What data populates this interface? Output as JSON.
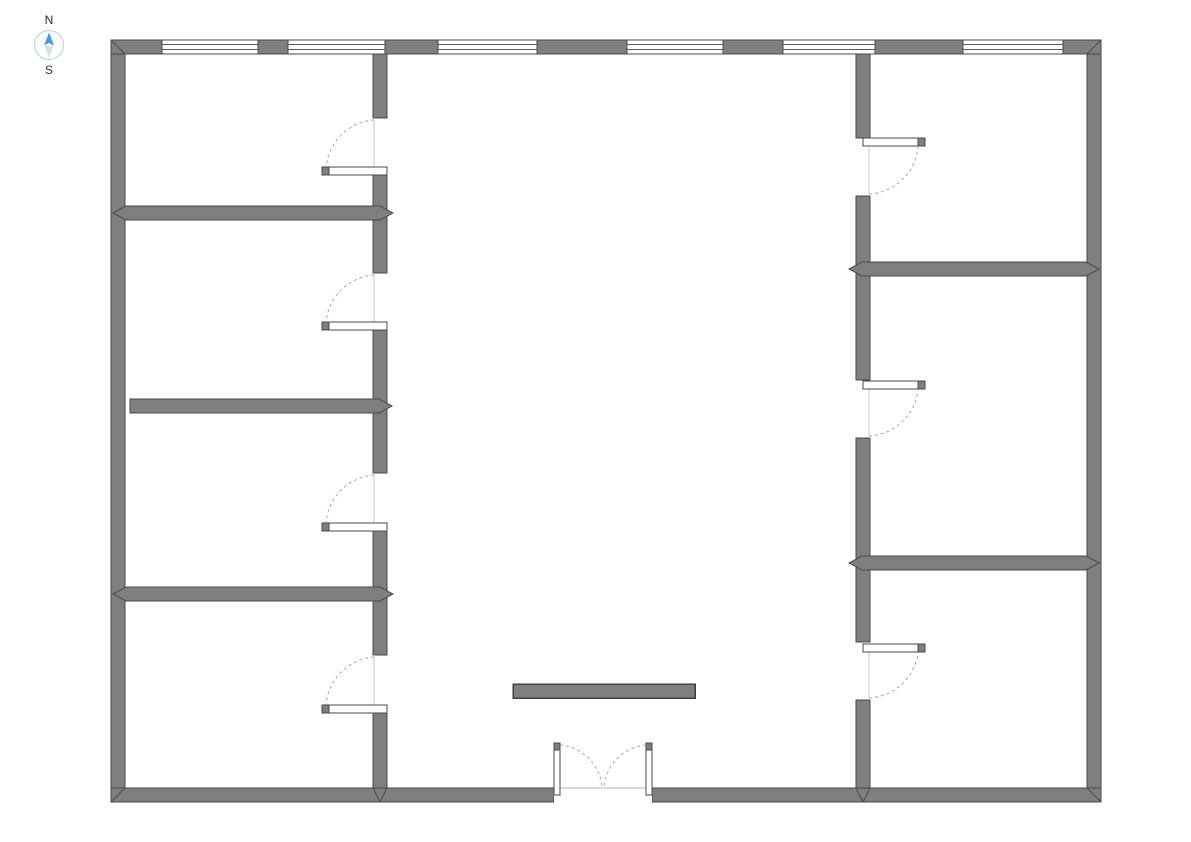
{
  "compass": {
    "north_label": "N",
    "south_label": "S"
  },
  "colors": {
    "background": "#ffffff",
    "wall_fill": "#7f7f7f",
    "wall_edge": "#4a4a4a",
    "window_fill": "#ffffff",
    "window_line": "#5a5a5a",
    "door_leaf_fill": "#ffffff",
    "door_leaf_edge": "#4a4a4a",
    "door_tip_fill": "#7f7f7f",
    "door_arc": "#a9a9a9",
    "door_frame": "#c9c9c9",
    "threshold": "#b4b4b4",
    "furniture_fill": "#7f7f7f",
    "furniture_edge": "#3f3f3f",
    "compass_north": "#3f9ce8",
    "compass_south": "#d9dee3",
    "compass_ring": "#b9d7ec"
  },
  "plan": {
    "canvas": {
      "w": 1191,
      "h": 842
    },
    "walls": [
      {
        "name": "exterior-wall-left",
        "x": 111,
        "y": 40,
        "w": 14,
        "h": 762
      },
      {
        "name": "exterior-wall-right",
        "x": 1087,
        "y": 40,
        "w": 14,
        "h": 762
      },
      {
        "name": "exterior-wall-top-segment-1",
        "x": 111,
        "y": 40,
        "w": 51,
        "h": 14
      },
      {
        "name": "exterior-wall-top-segment-2",
        "x": 258,
        "y": 40,
        "w": 30,
        "h": 14
      },
      {
        "name": "exterior-wall-top-segment-3",
        "x": 385,
        "y": 40,
        "w": 53,
        "h": 14
      },
      {
        "name": "exterior-wall-top-segment-4",
        "x": 537,
        "y": 40,
        "w": 90,
        "h": 14
      },
      {
        "name": "exterior-wall-top-segment-5",
        "x": 723,
        "y": 40,
        "w": 60,
        "h": 14
      },
      {
        "name": "exterior-wall-top-segment-6",
        "x": 875,
        "y": 40,
        "w": 88,
        "h": 14
      },
      {
        "name": "exterior-wall-top-segment-7",
        "x": 1063,
        "y": 40,
        "w": 38,
        "h": 14
      },
      {
        "name": "exterior-wall-bottom-segment-1",
        "x": 111,
        "y": 788,
        "w": 443,
        "h": 14
      },
      {
        "name": "exterior-wall-bottom-segment-2",
        "x": 652,
        "y": 788,
        "w": 449,
        "h": 14
      },
      {
        "name": "interior-wall-left-segment-1",
        "x": 373,
        "y": 54,
        "w": 14,
        "h": 64
      },
      {
        "name": "interior-wall-left-segment-2",
        "x": 373,
        "y": 175,
        "w": 14,
        "h": 98
      },
      {
        "name": "interior-wall-left-segment-3",
        "x": 373,
        "y": 330,
        "w": 14,
        "h": 143
      },
      {
        "name": "interior-wall-left-segment-4",
        "x": 373,
        "y": 531,
        "w": 14,
        "h": 124
      },
      {
        "name": "interior-wall-left-segment-5",
        "x": 373,
        "y": 713,
        "w": 14,
        "h": 75
      },
      {
        "name": "interior-wall-right-segment-1",
        "x": 856,
        "y": 54,
        "w": 14,
        "h": 84
      },
      {
        "name": "interior-wall-right-segment-2",
        "x": 856,
        "y": 196,
        "w": 14,
        "h": 184
      },
      {
        "name": "interior-wall-right-segment-3",
        "x": 856,
        "y": 438,
        "w": 14,
        "h": 204
      },
      {
        "name": "interior-wall-right-segment-4",
        "x": 856,
        "y": 700,
        "w": 14,
        "h": 88
      }
    ],
    "dividers": [
      {
        "name": "divider-wall-left-1",
        "points": "113,213 126,206 380,206 393,213 380,220 126,220"
      },
      {
        "name": "divider-wall-left-2",
        "points": "130,399 379,399 392,406 379,413 130,413"
      },
      {
        "name": "divider-wall-left-3",
        "points": "113,594 126,587 380,587 393,594 380,601 126,601"
      },
      {
        "name": "divider-wall-right-1",
        "points": "849,269 862,262 1086,262 1099,269 1086,276 862,276"
      },
      {
        "name": "divider-wall-right-2",
        "points": "849,563 862,556 1086,556 1099,563 1086,570 862,570"
      }
    ],
    "miters": [
      {
        "name": "corner-miter-top-left",
        "x1": 111,
        "y1": 40,
        "x2": 125,
        "y2": 54
      },
      {
        "name": "corner-miter-top-right",
        "x1": 1101,
        "y1": 40,
        "x2": 1087,
        "y2": 54
      },
      {
        "name": "corner-miter-bottom-left",
        "x1": 111,
        "y1": 802,
        "x2": 125,
        "y2": 788
      },
      {
        "name": "corner-miter-bottom-right",
        "x1": 1101,
        "y1": 802,
        "x2": 1087,
        "y2": 788
      },
      {
        "name": "tee-miter-left-wall-a",
        "x1": 373,
        "y1": 788,
        "x2": 380,
        "y2": 802
      },
      {
        "name": "tee-miter-left-wall-b",
        "x1": 387,
        "y1": 788,
        "x2": 380,
        "y2": 802
      },
      {
        "name": "tee-miter-right-wall-a",
        "x1": 856,
        "y1": 788,
        "x2": 863,
        "y2": 802
      },
      {
        "name": "tee-miter-right-wall-b",
        "x1": 870,
        "y1": 788,
        "x2": 863,
        "y2": 802
      }
    ],
    "windows": [
      {
        "name": "window-1",
        "x": 162,
        "y": 40,
        "w": 96,
        "h": 14
      },
      {
        "name": "window-2",
        "x": 288,
        "y": 40,
        "w": 97,
        "h": 14
      },
      {
        "name": "window-3",
        "x": 438,
        "y": 40,
        "w": 99,
        "h": 14
      },
      {
        "name": "window-4",
        "x": 627,
        "y": 40,
        "w": 96,
        "h": 14
      },
      {
        "name": "window-5",
        "x": 783,
        "y": 40,
        "w": 92,
        "h": 14
      },
      {
        "name": "window-6",
        "x": 963,
        "y": 40,
        "w": 100,
        "h": 14
      }
    ],
    "openings": [
      {
        "name": "entrance-opening",
        "x": 554,
        "y": 788,
        "w": 98,
        "h": 14
      }
    ],
    "thresholds": [
      {
        "name": "entrance-threshold",
        "x1": 554,
        "y1": 788,
        "x2": 652,
        "y2": 788
      }
    ],
    "furniture": [
      {
        "name": "table",
        "x": 513,
        "y": 684,
        "w": 182,
        "h": 14
      }
    ],
    "doors": [
      {
        "name": "door-room-left-1",
        "leaf": {
          "x": 322,
          "y": 167,
          "w": 65,
          "h": 8
        },
        "tip": {
          "x": 322,
          "y": 167,
          "w": 7,
          "h": 8
        },
        "frame": {
          "x1": 374,
          "y1": 118,
          "x2": 374,
          "y2": 167
        },
        "arc": {
          "x1": 374,
          "y1": 120,
          "x2": 326,
          "y2": 168,
          "r": 52,
          "sweep": 0
        }
      },
      {
        "name": "door-room-left-2",
        "leaf": {
          "x": 322,
          "y": 322,
          "w": 65,
          "h": 8
        },
        "tip": {
          "x": 322,
          "y": 322,
          "w": 7,
          "h": 8
        },
        "frame": {
          "x1": 374,
          "y1": 273,
          "x2": 374,
          "y2": 322
        },
        "arc": {
          "x1": 374,
          "y1": 275,
          "x2": 326,
          "y2": 323,
          "r": 52,
          "sweep": 0
        }
      },
      {
        "name": "door-room-left-3",
        "leaf": {
          "x": 322,
          "y": 523,
          "w": 65,
          "h": 8
        },
        "tip": {
          "x": 322,
          "y": 523,
          "w": 7,
          "h": 8
        },
        "frame": {
          "x1": 374,
          "y1": 473,
          "x2": 374,
          "y2": 523
        },
        "arc": {
          "x1": 374,
          "y1": 475,
          "x2": 326,
          "y2": 524,
          "r": 52,
          "sweep": 0
        }
      },
      {
        "name": "door-room-left-4",
        "leaf": {
          "x": 322,
          "y": 705,
          "w": 65,
          "h": 8
        },
        "tip": {
          "x": 322,
          "y": 705,
          "w": 7,
          "h": 8
        },
        "frame": {
          "x1": 374,
          "y1": 655,
          "x2": 374,
          "y2": 705
        },
        "arc": {
          "x1": 374,
          "y1": 657,
          "x2": 326,
          "y2": 706,
          "r": 52,
          "sweep": 0
        }
      },
      {
        "name": "door-room-right-1",
        "leaf": {
          "x": 863,
          "y": 138,
          "w": 62,
          "h": 8
        },
        "tip": {
          "x": 918,
          "y": 138,
          "w": 7,
          "h": 8
        },
        "frame": {
          "x1": 869,
          "y1": 146,
          "x2": 869,
          "y2": 196
        },
        "arc": {
          "x1": 869,
          "y1": 194,
          "x2": 918,
          "y2": 147,
          "r": 52,
          "sweep": 0
        }
      },
      {
        "name": "door-room-right-2",
        "leaf": {
          "x": 863,
          "y": 381,
          "w": 62,
          "h": 8
        },
        "tip": {
          "x": 918,
          "y": 381,
          "w": 7,
          "h": 8
        },
        "frame": {
          "x1": 869,
          "y1": 389,
          "x2": 869,
          "y2": 438
        },
        "arc": {
          "x1": 869,
          "y1": 436,
          "x2": 918,
          "y2": 390,
          "r": 52,
          "sweep": 0
        }
      },
      {
        "name": "door-room-right-3",
        "leaf": {
          "x": 863,
          "y": 644,
          "w": 62,
          "h": 8
        },
        "tip": {
          "x": 918,
          "y": 644,
          "w": 7,
          "h": 8
        },
        "frame": {
          "x1": 869,
          "y1": 652,
          "x2": 869,
          "y2": 700
        },
        "arc": {
          "x1": 869,
          "y1": 698,
          "x2": 918,
          "y2": 653,
          "r": 52,
          "sweep": 0
        }
      },
      {
        "name": "entrance-double-door-left-leaf",
        "leaf": {
          "x": 554,
          "y": 743,
          "w": 6,
          "h": 52
        },
        "tip": {
          "x": 554,
          "y": 743,
          "w": 6,
          "h": 7
        },
        "frame": null,
        "arc": {
          "x1": 560,
          "y1": 745,
          "x2": 602,
          "y2": 787,
          "r": 46,
          "sweep": 1
        }
      },
      {
        "name": "entrance-double-door-right-leaf",
        "leaf": {
          "x": 646,
          "y": 743,
          "w": 6,
          "h": 52
        },
        "tip": {
          "x": 646,
          "y": 743,
          "w": 6,
          "h": 7
        },
        "frame": null,
        "arc": {
          "x1": 646,
          "y1": 745,
          "x2": 604,
          "y2": 787,
          "r": 46,
          "sweep": 0
        }
      }
    ]
  }
}
